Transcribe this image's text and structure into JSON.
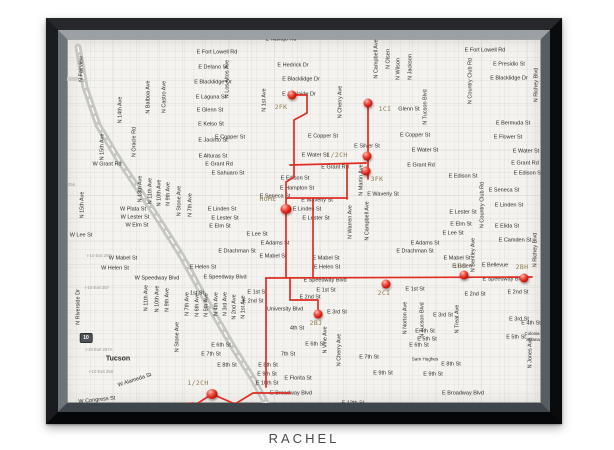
{
  "caption": "RACHEL",
  "map": {
    "city": "Tucson",
    "colors": {
      "route_red": "#e02d22",
      "pin_red": "#d2190f",
      "pin_label": "#8d7c4e",
      "street_text": "#2d2c2a",
      "paper": "#f4f3ef",
      "frame_black": "#0c0d0f",
      "bevel_gray": "#70777c",
      "highway_gray": "#c6c6c3",
      "caption_gray": "#4b4b4b"
    },
    "pins": [
      {
        "label": "2FK",
        "x": 307,
        "y": 88,
        "lx": 296,
        "ly": 100
      },
      {
        "label": "1CI",
        "x": 383,
        "y": 96,
        "lx": 400,
        "ly": 102
      },
      {
        "label": "1/2CH",
        "x": 382,
        "y": 149,
        "lx": 352,
        "ly": 148
      },
      {
        "label": "3FK",
        "x": 381,
        "y": 164,
        "lx": 392,
        "ly": 172
      },
      {
        "label": "HOME",
        "x": 301,
        "y": 202,
        "lx": 283,
        "ly": 192,
        "big": true
      },
      {
        "label": "2BJ",
        "x": 333,
        "y": 307,
        "lx": 331,
        "ly": 316
      },
      {
        "label": "2CI",
        "x": 401,
        "y": 277,
        "lx": 399,
        "ly": 286
      },
      {
        "label": "1BI",
        "x": 479,
        "y": 268,
        "lx": 475,
        "ly": 259
      },
      {
        "label": "2BH",
        "x": 539,
        "y": 271,
        "lx": 537,
        "ly": 260
      },
      {
        "label": "1/2CH",
        "x": 227,
        "y": 387,
        "lx": 213,
        "ly": 376,
        "big": true
      },
      {
        "label": "5CJ",
        "x": 206,
        "y": 400,
        "lx": 221,
        "ly": 399,
        "big": true
      }
    ],
    "red_routes": [
      [
        [
          307,
          88
        ],
        [
          322,
          88
        ],
        [
          322,
          106
        ],
        [
          309,
          113
        ],
        [
          309,
          158
        ]
      ],
      [
        [
          305,
          158
        ],
        [
          381,
          156
        ]
      ],
      [
        [
          383,
          96
        ],
        [
          383,
          172
        ]
      ],
      [
        [
          362,
          158
        ],
        [
          362,
          192
        ]
      ],
      [
        [
          301,
          191
        ],
        [
          362,
          191
        ]
      ],
      [
        [
          328,
          191
        ],
        [
          328,
          271
        ]
      ],
      [
        [
          309,
          158
        ],
        [
          309,
          170
        ],
        [
          301,
          175
        ],
        [
          301,
          271
        ]
      ],
      [
        [
          281,
          271
        ],
        [
          547,
          270
        ]
      ],
      [
        [
          305,
          271
        ],
        [
          305,
          293
        ],
        [
          333,
          293
        ],
        [
          333,
          307
        ]
      ],
      [
        [
          281,
          271
        ],
        [
          281,
          380
        ]
      ],
      [
        [
          305,
          386
        ],
        [
          268,
          386
        ],
        [
          250,
          397
        ],
        [
          227,
          387
        ],
        [
          207,
          400
        ]
      ]
    ],
    "highway_segments": {
      "i10": [
        [
          93,
          40
        ],
        [
          100,
          80
        ],
        [
          113,
          118
        ],
        [
          132,
          150
        ],
        [
          152,
          180
        ],
        [
          172,
          210
        ],
        [
          196,
          248
        ],
        [
          222,
          295
        ],
        [
          248,
          340
        ],
        [
          268,
          372
        ],
        [
          282,
          398
        ]
      ],
      "miracle_mile": [
        [
          16,
          72
        ],
        [
          92,
          72
        ]
      ]
    },
    "route_shields": [
      {
        "t": "10",
        "x": 73,
        "y": 197,
        "variant": "interstate"
      },
      {
        "t": "10",
        "x": 101,
        "y": 331,
        "variant": "interstate"
      },
      {
        "t": "77",
        "x": 57,
        "y": 73,
        "variant": "oval"
      }
    ],
    "exit_labels": [
      {
        "t": "I-10 Exit 255",
        "x": 32,
        "y": 132
      },
      {
        "t": "I-10 Exit 256",
        "x": 78,
        "y": 178
      },
      {
        "t": "I-10 Exit 257",
        "x": 114,
        "y": 249
      },
      {
        "t": "I-10 Exit 257",
        "x": 112,
        "y": 281
      },
      {
        "t": "I-10 Exit 257A",
        "x": 114,
        "y": 343
      },
      {
        "t": "I-10 Exit 258",
        "x": 116,
        "y": 365
      }
    ],
    "streets_h": [
      {
        "t": "E Navajo Rd",
        "x": 296,
        "y": 33
      },
      {
        "t": "E Fort Lowell Rd",
        "x": 232,
        "y": 46
      },
      {
        "t": "E Fort Lowell Rd",
        "x": 500,
        "y": 44
      },
      {
        "t": "E Delano St",
        "x": 228,
        "y": 61
      },
      {
        "t": "E Hedrick Dr",
        "x": 308,
        "y": 59
      },
      {
        "t": "E Presidio St",
        "x": 524,
        "y": 58
      },
      {
        "t": "E Blacklidge Dr",
        "x": 228,
        "y": 76
      },
      {
        "t": "E Blacklidge Dr",
        "x": 316,
        "y": 73
      },
      {
        "t": "E Blacklidge Dr",
        "x": 524,
        "y": 72
      },
      {
        "t": "E Laguna St",
        "x": 226,
        "y": 91
      },
      {
        "t": "E Adelaide Dr",
        "x": 314,
        "y": 88
      },
      {
        "t": "E Glenn St",
        "x": 225,
        "y": 104
      },
      {
        "t": "Glenn St",
        "x": 424,
        "y": 103
      },
      {
        "t": "E Kelso St",
        "x": 226,
        "y": 118
      },
      {
        "t": "E Jacinto St",
        "x": 228,
        "y": 134
      },
      {
        "t": "E Copper St",
        "x": 245,
        "y": 131
      },
      {
        "t": "E Copper St",
        "x": 338,
        "y": 130
      },
      {
        "t": "E Copper St",
        "x": 430,
        "y": 129
      },
      {
        "t": "E Alturas St",
        "x": 228,
        "y": 150
      },
      {
        "t": "E Silver St",
        "x": 382,
        "y": 140
      },
      {
        "t": "E Water St",
        "x": 330,
        "y": 149
      },
      {
        "t": "E Water St",
        "x": 440,
        "y": 144
      },
      {
        "t": "E Water St",
        "x": 541,
        "y": 145
      },
      {
        "t": "E Bermuda St",
        "x": 528,
        "y": 117
      },
      {
        "t": "E Flower St",
        "x": 523,
        "y": 131
      },
      {
        "t": "dle Mile",
        "x": 28,
        "y": 73
      },
      {
        "t": "nn St",
        "x": 12,
        "y": 100
      },
      {
        "t": "W Grant Rd",
        "x": 122,
        "y": 158
      },
      {
        "t": "E Grant Rd",
        "x": 234,
        "y": 158
      },
      {
        "t": "E Sahuaro St",
        "x": 243,
        "y": 167
      },
      {
        "t": "E Grant Rd",
        "x": 350,
        "y": 161
      },
      {
        "t": "E Grant Rd",
        "x": 436,
        "y": 159
      },
      {
        "t": "E Grant Rd",
        "x": 540,
        "y": 157
      },
      {
        "t": "E Edison St",
        "x": 310,
        "y": 172
      },
      {
        "t": "E Edison St",
        "x": 478,
        "y": 170
      },
      {
        "t": "E Edison St",
        "x": 543,
        "y": 167
      },
      {
        "t": "E Hampton St",
        "x": 312,
        "y": 182
      },
      {
        "t": "E Seneca St",
        "x": 290,
        "y": 190
      },
      {
        "t": "E Seneca St",
        "x": 519,
        "y": 184
      },
      {
        "t": "E Waverly St",
        "x": 332,
        "y": 194
      },
      {
        "t": "E Waverly St",
        "x": 398,
        "y": 188
      },
      {
        "t": "E Linden St",
        "x": 237,
        "y": 203
      },
      {
        "t": "E Linden St",
        "x": 322,
        "y": 203
      },
      {
        "t": "E Linden St",
        "x": 524,
        "y": 199
      },
      {
        "t": "E Lester St",
        "x": 240,
        "y": 212
      },
      {
        "t": "E Lester St",
        "x": 331,
        "y": 212
      },
      {
        "t": "E Lester St",
        "x": 478,
        "y": 206
      },
      {
        "t": "W Plata St",
        "x": 148,
        "y": 203
      },
      {
        "t": "W Lester St",
        "x": 150,
        "y": 211
      },
      {
        "t": "W Elm St",
        "x": 152,
        "y": 219
      },
      {
        "t": "E Elm St",
        "x": 235,
        "y": 220
      },
      {
        "t": "E Elm St",
        "x": 476,
        "y": 218
      },
      {
        "t": "W Lee St",
        "x": 96,
        "y": 229
      },
      {
        "t": "E Lee St",
        "x": 272,
        "y": 228
      },
      {
        "t": "E Lee St",
        "x": 468,
        "y": 227
      },
      {
        "t": "E Adams St",
        "x": 290,
        "y": 237
      },
      {
        "t": "E Adams St",
        "x": 440,
        "y": 237
      },
      {
        "t": "E Drachman St",
        "x": 252,
        "y": 245
      },
      {
        "t": "E Drachman St",
        "x": 430,
        "y": 245
      },
      {
        "t": "W Mabel St",
        "x": 138,
        "y": 252
      },
      {
        "t": "E Mabel St",
        "x": 288,
        "y": 250
      },
      {
        "t": "E Mabel St",
        "x": 341,
        "y": 252
      },
      {
        "t": "E Mabel St",
        "x": 472,
        "y": 252
      },
      {
        "t": "W Helen St",
        "x": 130,
        "y": 262
      },
      {
        "t": "E Helen St",
        "x": 218,
        "y": 261
      },
      {
        "t": "E Helen St",
        "x": 342,
        "y": 261
      },
      {
        "t": "E Helen",
        "x": 477,
        "y": 260
      },
      {
        "t": "E Camden St",
        "x": 530,
        "y": 234
      },
      {
        "t": "E Elida St",
        "x": 522,
        "y": 220
      },
      {
        "t": "E Bellevue",
        "x": 510,
        "y": 259
      },
      {
        "t": "W Speedway Blvd",
        "x": 172,
        "y": 272
      },
      {
        "t": "E Speedway Blvd",
        "x": 240,
        "y": 271
      },
      {
        "t": "E Speedway Blvd",
        "x": 340,
        "y": 274
      },
      {
        "t": "E Speedway Blvd",
        "x": 519,
        "y": 273
      },
      {
        "t": "dway Blvd",
        "x": 30,
        "y": 268
      },
      {
        "t": "Delaware St",
        "x": 32,
        "y": 277
      },
      {
        "t": "Clair St",
        "x": 55,
        "y": 298
      },
      {
        "t": "ara St",
        "x": 16,
        "y": 307
      },
      {
        "t": "Saint Marys Rd",
        "x": 58,
        "y": 322
      },
      {
        "t": "1st St",
        "x": 212,
        "y": 287
      },
      {
        "t": "E 1st St",
        "x": 272,
        "y": 286
      },
      {
        "t": "E 1st St",
        "x": 341,
        "y": 284
      },
      {
        "t": "E 1st St",
        "x": 430,
        "y": 283
      },
      {
        "t": "E 2nd St",
        "x": 268,
        "y": 295
      },
      {
        "t": "E 2nd St",
        "x": 325,
        "y": 291
      },
      {
        "t": "E 2nd St",
        "x": 490,
        "y": 288
      },
      {
        "t": "E 2nd St",
        "x": 533,
        "y": 286
      },
      {
        "t": "University Blvd",
        "x": 300,
        "y": 303
      },
      {
        "t": "E 3rd St",
        "x": 352,
        "y": 306
      },
      {
        "t": "E 3rd St",
        "x": 458,
        "y": 309
      },
      {
        "t": "E 3rd St",
        "x": 534,
        "y": 313
      },
      {
        "t": "4th St",
        "x": 312,
        "y": 322
      },
      {
        "t": "E 4th St",
        "x": 440,
        "y": 325
      },
      {
        "t": "E 4th St",
        "x": 546,
        "y": 317
      },
      {
        "t": "E 5th St",
        "x": 442,
        "y": 333
      },
      {
        "t": "E 5th St",
        "x": 531,
        "y": 331
      },
      {
        "t": "E 6th St",
        "x": 236,
        "y": 339
      },
      {
        "t": "E 6th St",
        "x": 330,
        "y": 338
      },
      {
        "t": "E 6th St",
        "x": 434,
        "y": 339
      },
      {
        "t": "E 7th St",
        "x": 226,
        "y": 348
      },
      {
        "t": "7th St",
        "x": 303,
        "y": 348
      },
      {
        "t": "E 7th St",
        "x": 384,
        "y": 351
      },
      {
        "t": "Sam Hughes",
        "x": 440,
        "y": 353,
        "s": 4.6
      },
      {
        "t": "E 8th St",
        "x": 242,
        "y": 359
      },
      {
        "t": "E 8th St",
        "x": 283,
        "y": 359
      },
      {
        "t": "E 8th St",
        "x": 466,
        "y": 358
      },
      {
        "t": "E 9th St",
        "x": 282,
        "y": 368
      },
      {
        "t": "E 9th St",
        "x": 398,
        "y": 367
      },
      {
        "t": "E 9th St",
        "x": 448,
        "y": 368
      },
      {
        "t": "E 10th St",
        "x": 282,
        "y": 377
      },
      {
        "t": "E Florita St",
        "x": 313,
        "y": 372
      },
      {
        "t": "E Broadway Blvd",
        "x": 306,
        "y": 387
      },
      {
        "t": "E Broadway Blvd",
        "x": 478,
        "y": 387
      },
      {
        "t": "E 12th St",
        "x": 368,
        "y": 397
      },
      {
        "t": "W Congress St",
        "x": 112,
        "y": 394,
        "r": -6
      },
      {
        "t": "W Alameda St",
        "x": 150,
        "y": 374,
        "r": -18
      },
      {
        "t": "Tucson",
        "x": 133,
        "y": 352,
        "w": 1,
        "s": 7
      },
      {
        "t": "Colonia",
        "x": 547,
        "y": 327,
        "s": 4.4
      },
      {
        "t": "Solana",
        "x": 548,
        "y": 333,
        "s": 4.4
      }
    ],
    "streets_v": [
      {
        "t": "N Fairview",
        "x": 97,
        "y": 62
      },
      {
        "t": "N Balboa Ave",
        "x": 164,
        "y": 90
      },
      {
        "t": "N Castro Ave",
        "x": 180,
        "y": 90
      },
      {
        "t": "N 14th Ave",
        "x": 136,
        "y": 103
      },
      {
        "t": "N 15th Ave",
        "x": 118,
        "y": 140
      },
      {
        "t": "N Oracle Rd",
        "x": 150,
        "y": 135
      },
      {
        "t": "N 15th Ave",
        "x": 98,
        "y": 198
      },
      {
        "t": "N 13th Ave",
        "x": 156,
        "y": 182
      },
      {
        "t": "N 11th Ave",
        "x": 166,
        "y": 184
      },
      {
        "t": "N 10th Ave",
        "x": 175,
        "y": 186
      },
      {
        "t": "N 9th Ave",
        "x": 184,
        "y": 187
      },
      {
        "t": "N Stone Ave",
        "x": 195,
        "y": 194
      },
      {
        "t": "N 7th Ave",
        "x": 206,
        "y": 198
      },
      {
        "t": "N 1st Ave",
        "x": 280,
        "y": 93
      },
      {
        "t": "N Los Altos Ave",
        "x": 243,
        "y": 72
      },
      {
        "t": "N Campbell Ave",
        "x": 392,
        "y": 52
      },
      {
        "t": "N Olsen",
        "x": 404,
        "y": 52
      },
      {
        "t": "N Wilson",
        "x": 414,
        "y": 62
      },
      {
        "t": "N Jackson",
        "x": 426,
        "y": 60
      },
      {
        "t": "N Tucson Blvd",
        "x": 441,
        "y": 100
      },
      {
        "t": "N Tucson Blvd",
        "x": 438,
        "y": 313
      },
      {
        "t": "N Cherry Ave",
        "x": 356,
        "y": 95
      },
      {
        "t": "N Cherry Ave",
        "x": 355,
        "y": 343
      },
      {
        "t": "N Campbell Ave",
        "x": 383,
        "y": 214
      },
      {
        "t": "N Warren Ave",
        "x": 366,
        "y": 215
      },
      {
        "t": "N Martin Ave",
        "x": 377,
        "y": 173
      },
      {
        "t": "N Country Club Rd",
        "x": 486,
        "y": 74
      },
      {
        "t": "N Country Club Rd",
        "x": 498,
        "y": 198
      },
      {
        "t": "N Richey Blvd",
        "x": 552,
        "y": 78
      },
      {
        "t": "N Richey Blvd",
        "x": 551,
        "y": 243
      },
      {
        "t": "N Bentley Ave",
        "x": 489,
        "y": 248
      },
      {
        "t": "N Norton Ave",
        "x": 421,
        "y": 311
      },
      {
        "t": "N Treat Ave",
        "x": 473,
        "y": 312
      },
      {
        "t": "N Vine Ave",
        "x": 341,
        "y": 333
      },
      {
        "t": "N Jones Ave",
        "x": 546,
        "y": 346
      },
      {
        "t": "N Riverside Dr",
        "x": 94,
        "y": 300
      },
      {
        "t": "N Grande Ave",
        "x": 74,
        "y": 381
      },
      {
        "t": "N 11th Ave",
        "x": 162,
        "y": 291
      },
      {
        "t": "N 10th Ave",
        "x": 173,
        "y": 292
      },
      {
        "t": "N 9th Ave",
        "x": 183,
        "y": 293
      },
      {
        "t": "N 7th Ave",
        "x": 203,
        "y": 297
      },
      {
        "t": "N 6th Ave",
        "x": 213,
        "y": 298
      },
      {
        "t": "N 5th Ave",
        "x": 222,
        "y": 298
      },
      {
        "t": "N 4th Ave",
        "x": 232,
        "y": 297
      },
      {
        "t": "N 3rd Ave",
        "x": 241,
        "y": 297
      },
      {
        "t": "N 2nd Ave",
        "x": 250,
        "y": 300
      },
      {
        "t": "N 1st Ave",
        "x": 259,
        "y": 300
      },
      {
        "t": "N Stone Ave",
        "x": 193,
        "y": 330
      }
    ]
  }
}
